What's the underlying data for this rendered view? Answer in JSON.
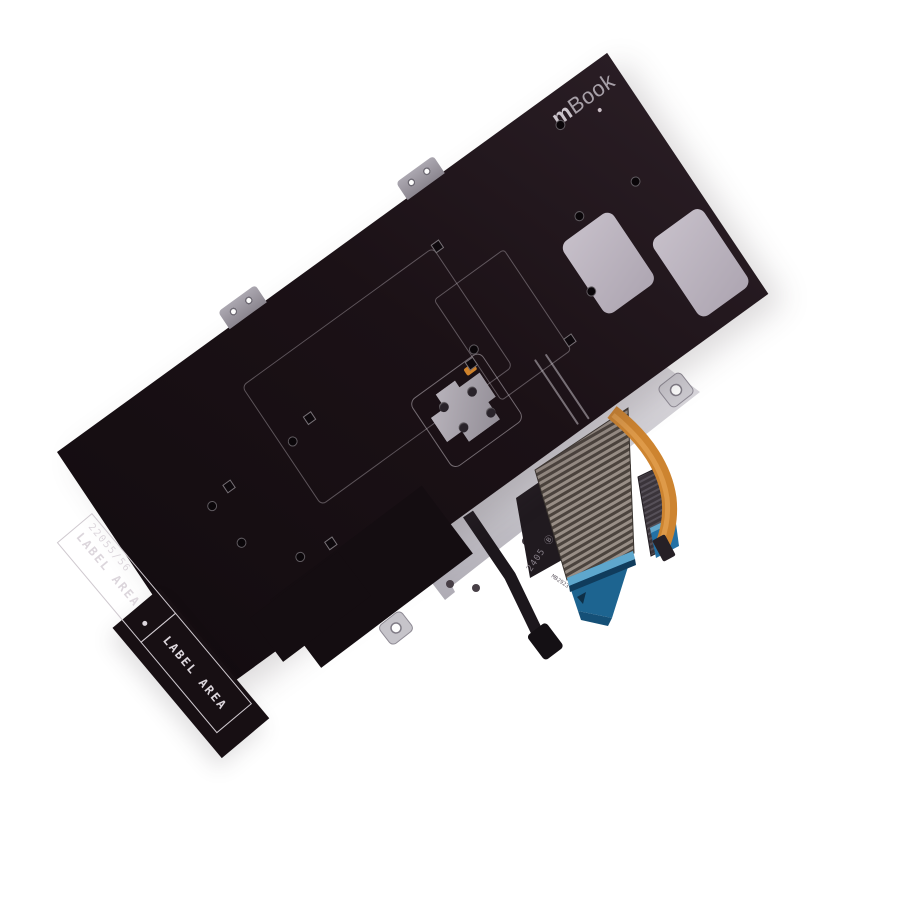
{
  "scene": {
    "background_color": "#ffffff"
  },
  "board": {
    "color": "#1b1116",
    "logo": {
      "bold": "m",
      "rest": "Book"
    }
  },
  "label_band": {
    "part_number": "22055/56",
    "cell1_label": "LABEL AREA",
    "cell1_bullet": "•",
    "cell2_label": "LABEL AREA"
  },
  "plate": {
    "color": "#c9c6cd",
    "marking_primary": "2405 Ⓑ",
    "marking_secondary": "MB2923"
  },
  "cables": {
    "main_connector_color": "#1d6490",
    "trackpoint_connector_color": "#2371a5",
    "backlight_cable_color": "#cd8430"
  }
}
